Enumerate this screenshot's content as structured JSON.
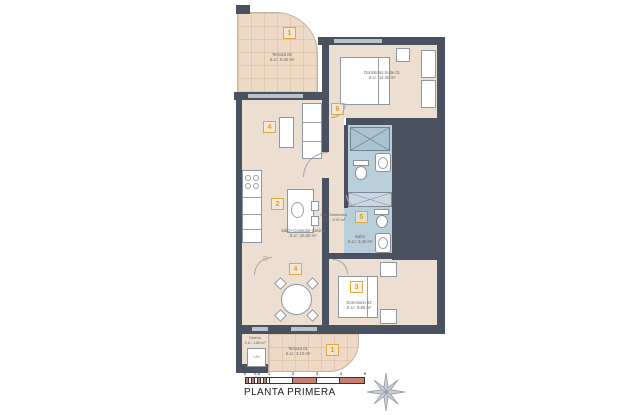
{
  "plan": {
    "title": "PLANTA PRIMERA",
    "rooms": {
      "terraza02": {
        "num": "1",
        "name": "Terraza 02",
        "area": "S.U.: 8.40 m²"
      },
      "suite": {
        "num": "6",
        "name": "Dormitorio Suite 01",
        "area": "S.U.: 14.30 m²"
      },
      "salon": {
        "num_living": "4",
        "num_kitchen": "2",
        "num_dining": "4",
        "name": "Salón-Comedor-Cocina",
        "area": "S.U.: 26.30 m²"
      },
      "hall": {
        "name": "Hall-Distribuidor",
        "area": "S.U.: 3.50 m²"
      },
      "bano": {
        "num": "5",
        "name": "Baño",
        "area": "S.U.: 3.40 m²"
      },
      "dorm02": {
        "num": "3",
        "name": "Dormitorio 02",
        "area": "S.U.: 8.80 m²"
      },
      "galeria": {
        "name": "Galería",
        "area": "S.U.: 1.60 m²"
      },
      "terraza01": {
        "num": "1",
        "name": "Terraza 01",
        "area": "S.U.: 3.10 m²"
      }
    },
    "door_letter": "D",
    "washer_label": "LAV",
    "scale": {
      "ticks": [
        "0",
        "0.5",
        "1",
        "2",
        "3",
        "4",
        "5"
      ]
    },
    "colors": {
      "wall": "#4a5160",
      "floor": "#ecdfd2",
      "terrace": "#edd9c5",
      "bath": "#b9cedb",
      "accent": "#e2a83e",
      "scale_red": "#c67e70",
      "window": "#bcc2ca"
    }
  }
}
